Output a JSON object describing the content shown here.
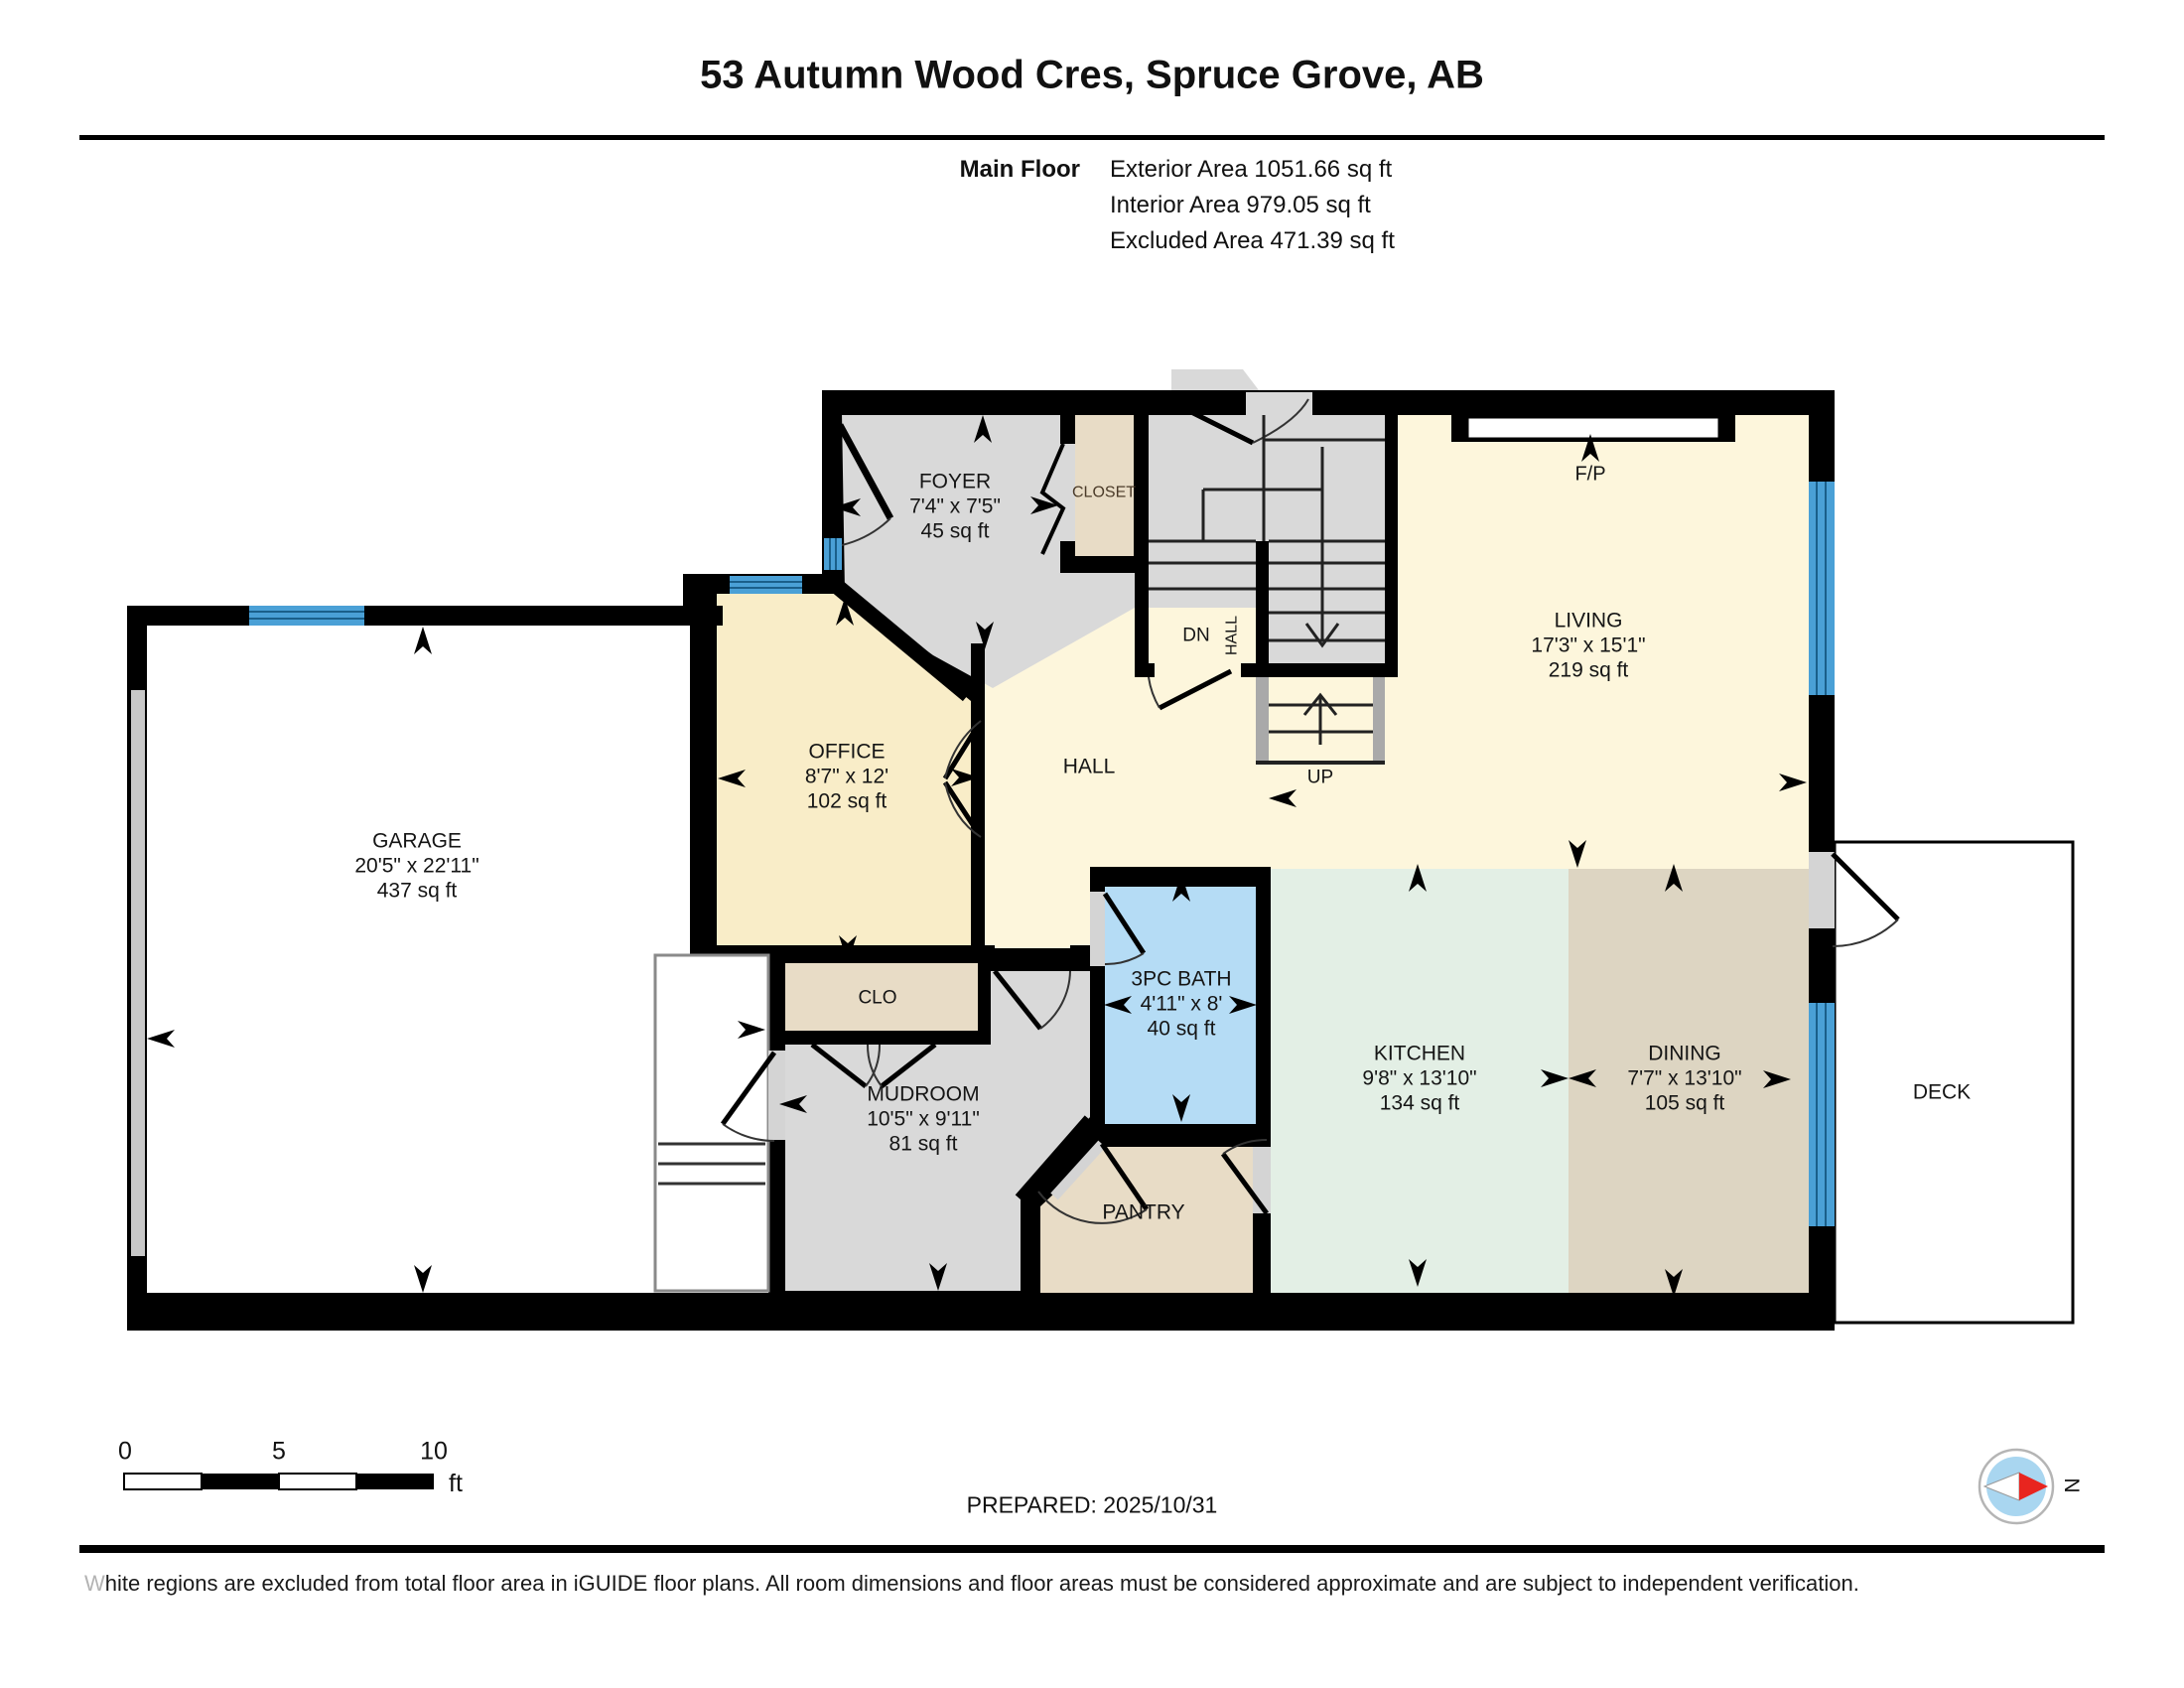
{
  "header": {
    "title": "53 Autumn Wood Cres, Spruce Grove, AB",
    "floor_label": "Main Floor",
    "exterior_area": "Exterior Area 1051.66 sq ft",
    "interior_area": "Interior Area 979.05 sq ft",
    "excluded_area": "Excluded Area 471.39 sq ft"
  },
  "rooms": {
    "foyer": {
      "name": "FOYER",
      "dims": "7'4\" x 7'5\"",
      "area": "45 sq ft"
    },
    "closet": {
      "name": "CLOSET"
    },
    "living": {
      "name": "LIVING",
      "dims": "17'3\" x 15'1\"",
      "area": "219 sq ft"
    },
    "office": {
      "name": "OFFICE",
      "dims": "8'7\" x 12'",
      "area": "102 sq ft"
    },
    "garage": {
      "name": "GARAGE",
      "dims": "20'5\" x 22'11\"",
      "area": "437 sq ft"
    },
    "hall": {
      "name": "HALL"
    },
    "clo": {
      "name": "CLO"
    },
    "mudroom": {
      "name": "MUDROOM",
      "dims": "10'5\" x 9'11\"",
      "area": "81 sq ft"
    },
    "bath": {
      "name": "3PC BATH",
      "dims": "4'11\" x 8'",
      "area": "40 sq ft"
    },
    "pantry": {
      "name": "PANTRY"
    },
    "kitchen": {
      "name": "KITCHEN",
      "dims": "9'8\" x 13'10\"",
      "area": "134 sq ft"
    },
    "dining": {
      "name": "DINING",
      "dims": "7'7\" x 13'10\"",
      "area": "105 sq ft"
    },
    "deck": {
      "name": "DECK"
    }
  },
  "stairs": {
    "dn": "DN",
    "up": "UP",
    "hall_vertical": "HALL"
  },
  "fireplace": {
    "label": "F/P"
  },
  "scale_bar": {
    "tick_0": "0",
    "tick_5": "5",
    "tick_10": "10",
    "unit": "ft"
  },
  "compass": {
    "north": "N"
  },
  "footer": {
    "prepared": "PREPARED: 2025/10/31",
    "disclaimer_lead": "W",
    "disclaimer_rest": "hite regions are excluded from total floor area in iGUIDE floor plans. All room dimensions and floor areas must be considered approximate and are subject to independent verification."
  },
  "colors": {
    "wall": "#000000",
    "gray_room": "#d9d9d9",
    "closet_tan": "#e8dcc6",
    "office_cream": "#f9edc8",
    "living_cream": "#fdf6dc",
    "kitchen_mint": "#e3efe5",
    "dining_tan": "#ddd5c2",
    "bath_blue": "#b5dcf5",
    "window_blue": "#4aa0d6",
    "door_jamb": "#d4d4d4",
    "compass_blue": "#a9d6f0",
    "compass_red": "#e8251f"
  }
}
